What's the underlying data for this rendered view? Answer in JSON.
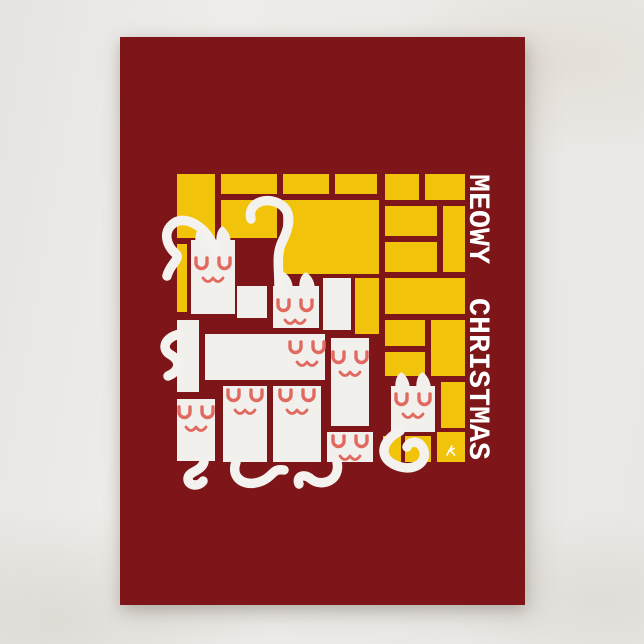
{
  "page": {
    "background_color": "#EBE9E6"
  },
  "card": {
    "background_color": "#7E1518",
    "title": "MEOWY CHRISTMAS",
    "title_color": "#FFFFFF"
  },
  "artwork": {
    "canvas_size": 290,
    "colors": {
      "yellow": "#F2C30B",
      "white": "#F2F0ED",
      "face": "#E06A60",
      "tail": "#F4F2EF",
      "signature": "#FFFFFF"
    },
    "yellow_blocks": [
      [
        0,
        0,
        38,
        64
      ],
      [
        0,
        70,
        10,
        68
      ],
      [
        44,
        0,
        56,
        20
      ],
      [
        44,
        26,
        56,
        38
      ],
      [
        106,
        0,
        46,
        20
      ],
      [
        158,
        0,
        42,
        20
      ],
      [
        106,
        26,
        96,
        74
      ],
      [
        208,
        0,
        34,
        26
      ],
      [
        248,
        0,
        40,
        26
      ],
      [
        208,
        32,
        52,
        30
      ],
      [
        266,
        32,
        22,
        66
      ],
      [
        208,
        68,
        52,
        30
      ],
      [
        208,
        104,
        80,
        36
      ],
      [
        178,
        104,
        24,
        56
      ],
      [
        208,
        146,
        40,
        26
      ],
      [
        254,
        146,
        34,
        56
      ],
      [
        208,
        178,
        40,
        24
      ],
      [
        264,
        208,
        24,
        46
      ],
      [
        206,
        262,
        18,
        26
      ],
      [
        228,
        262,
        26,
        26
      ],
      [
        260,
        258,
        28,
        30
      ]
    ],
    "white_blocks": [
      [
        0,
        146,
        22,
        72
      ],
      [
        60,
        112,
        30,
        32
      ],
      [
        146,
        104,
        28,
        52
      ],
      [
        28,
        160,
        120,
        46
      ]
    ],
    "cats": [
      {
        "name": "cat-a",
        "block": [
          14,
          66,
          44,
          74
        ],
        "ears": true,
        "face": [
          36,
          84
        ]
      },
      {
        "name": "cat-b",
        "block": [
          96,
          112,
          46,
          42
        ],
        "ears": true,
        "face": [
          118,
          126
        ]
      },
      {
        "name": "cat-c",
        "block": null,
        "ears": false,
        "face": [
          130,
          168
        ]
      },
      {
        "name": "cat-d",
        "block": [
          154,
          164,
          38,
          88
        ],
        "ears": false,
        "face": [
          173,
          178
        ]
      },
      {
        "name": "cat-e",
        "block": [
          46,
          212,
          44,
          76
        ],
        "ears": false,
        "face": [
          68,
          216
        ]
      },
      {
        "name": "cat-f",
        "block": [
          96,
          212,
          48,
          76
        ],
        "ears": false,
        "face": [
          120,
          216
        ]
      },
      {
        "name": "cat-g",
        "block": [
          0,
          225,
          38,
          62
        ],
        "ears": false,
        "face": [
          19,
          233
        ]
      },
      {
        "name": "cat-h",
        "block": [
          150,
          258,
          46,
          30
        ],
        "ears": false,
        "face": [
          173,
          262
        ]
      },
      {
        "name": "cat-i",
        "block": [
          214,
          212,
          44,
          46
        ],
        "ears": true,
        "face": [
          236,
          220
        ]
      }
    ],
    "tails": [
      "M 38 78 C 34 56 10 40 -3 49 C -16 58 -9 73 -2 79 C 5 85 -7 89 -10 102",
      "M 102 112 C 102 93 99 81 105 68 C 112 54 117 37 101 29 C 86 22 70 31 74 45",
      "M 3 160 C -12 163 -17 175 -6 181 C 4 187 3 197 -9 202",
      "M 27 288 C 24 298 11 297 11 305 C 11 312 22 313 26 307",
      "M 59 288 C 53 305 69 314 85 307 C 97 302 95 294 107 296",
      "M 160 288 C 164 306 145 314 134 305 C 127 299 119 302 122 310",
      "M 223 257 C 207 265 200 281 216 290 C 233 299 250 291 247 277 C 244 266 233 266 230 273"
    ],
    "signature_mark": {
      "paths": [
        "M 270 281 L 275 272",
        "M 271.5 277 L 277 274.5",
        "M 273.5 276.5 L 277.5 281"
      ],
      "position": [
        270,
        272
      ]
    }
  }
}
